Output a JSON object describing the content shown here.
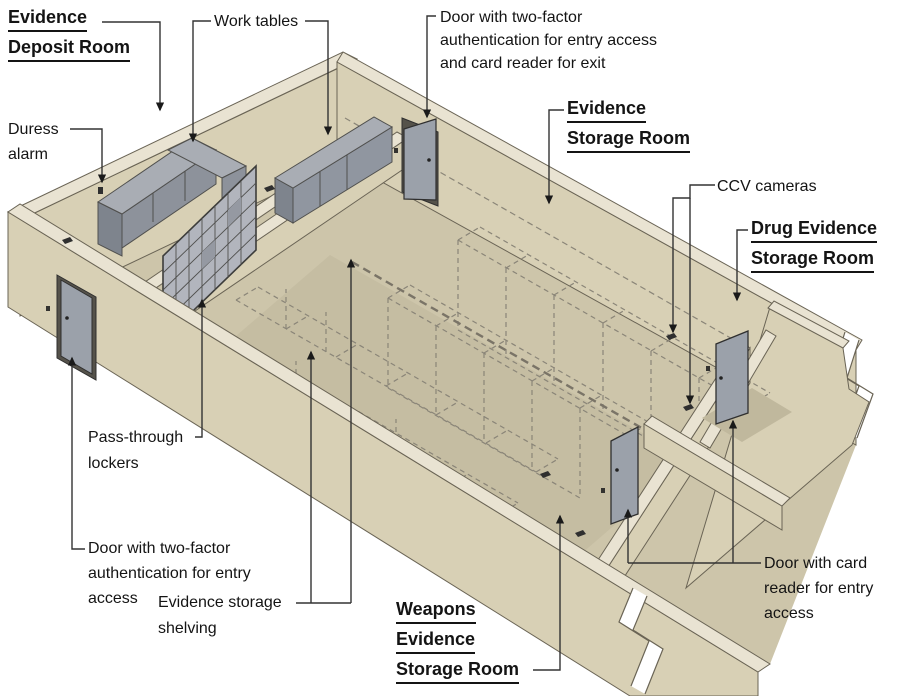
{
  "diagram_title": "Evidence storage facility isometric diagram",
  "colors": {
    "wall": "#d8d0b5",
    "wall_top_band": "#e9e3d2",
    "wall_edge": "#6a6455",
    "floor": "#cdc5aa",
    "floor_shadow": "#c5bda2",
    "door_gray": "#9ba1aa",
    "door_frame": "#55524a",
    "table_top": "#a9adb4",
    "table_front": "#9096a0",
    "locker_gray": "#b2b5bd",
    "dashed_shelving": "#8a8578",
    "leader_line": "#333333",
    "text": "#141414"
  },
  "labels": {
    "evidence_deposit_room": {
      "lines": [
        "Evidence",
        "Deposit Room"
      ]
    },
    "work_tables": {
      "lines": [
        "Work tables"
      ]
    },
    "door_two_factor_exit": {
      "lines": [
        "Door with two-factor",
        "authentication for entry access",
        "and card reader for exit"
      ]
    },
    "evidence_storage_room": {
      "lines": [
        "Evidence",
        "Storage Room"
      ]
    },
    "ccv_cameras": {
      "lines": [
        "CCV cameras"
      ]
    },
    "drug_evidence_storage_room": {
      "lines": [
        "Drug Evidence",
        "Storage Room"
      ]
    },
    "duress_alarm": {
      "lines": [
        "Duress",
        "alarm"
      ]
    },
    "pass_through_lockers": {
      "lines": [
        "Pass-through",
        "lockers"
      ]
    },
    "door_two_factor_entry": {
      "lines": [
        "Door with two-factor",
        "authentication for entry",
        "access"
      ]
    },
    "evidence_storage_shelving": {
      "lines": [
        "Evidence storage",
        "shelving"
      ]
    },
    "weapons_evidence_storage_room": {
      "lines": [
        "Weapons",
        "Evidence",
        "Storage Room"
      ]
    },
    "door_card_reader": {
      "lines": [
        "Door with card",
        "reader for entry",
        "access"
      ]
    }
  }
}
